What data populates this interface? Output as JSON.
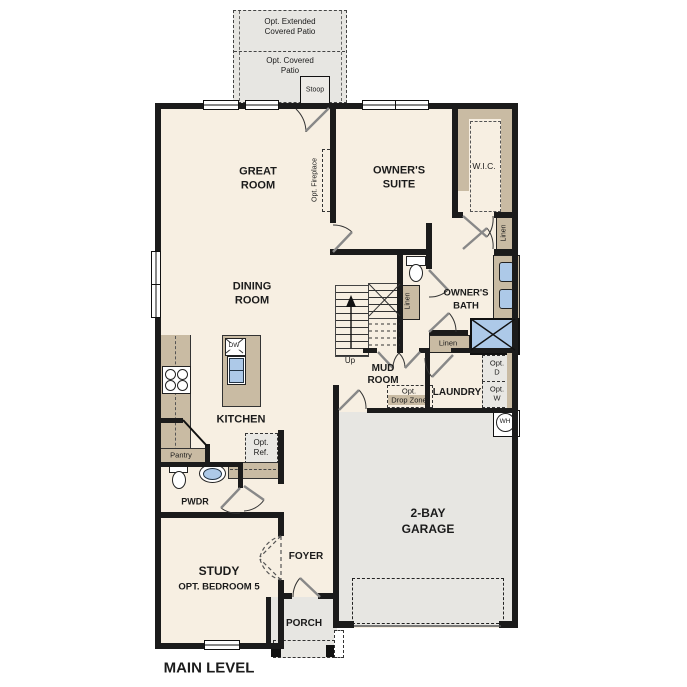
{
  "plan_title": "MAIN LEVEL",
  "outdoor": {
    "patio_extended": {
      "l1": "Opt. Extended",
      "l2": "Covered Patio"
    },
    "patio_covered": {
      "l1": "Opt. Covered",
      "l2": "Patio"
    },
    "stoop": "Stoop",
    "porch": "PORCH"
  },
  "rooms": {
    "great_room": {
      "l1": "GREAT",
      "l2": "ROOM"
    },
    "owners_suite": {
      "l1": "OWNER'S",
      "l2": "SUITE"
    },
    "wic": "W.I.C.",
    "dining": {
      "l1": "DINING",
      "l2": "ROOM"
    },
    "owners_bath": {
      "l1": "OWNER'S",
      "l2": "BATH"
    },
    "kitchen": "KITCHEN",
    "mud_room": {
      "l1": "MUD",
      "l2": "ROOM"
    },
    "laundry": "LAUNDRY",
    "pwdr": "PWDR",
    "study": {
      "l1": "STUDY",
      "l2": "OPT. BEDROOM 5"
    },
    "foyer": "FOYER",
    "garage": {
      "l1": "2-BAY",
      "l2": "GARAGE"
    }
  },
  "features": {
    "opt_fireplace": "Opt. Fireplace",
    "linen_hall": "Linen",
    "linen_stairs": "Linen",
    "linen_bath": "Linen",
    "up": "Up",
    "pantry": "Pantry",
    "opt_ref": {
      "l1": "Opt.",
      "l2": "Ref."
    },
    "dishwasher": "DW",
    "opt_drop_zone": {
      "l1": "Opt.",
      "l2": "Drop Zone"
    },
    "opt_dryer": {
      "l1": "Opt.",
      "l2": "D"
    },
    "opt_washer": {
      "l1": "Opt.",
      "l2": "W"
    },
    "water_heater": "WH"
  },
  "colors": {
    "wall": "#1b1b1b",
    "floor": "#f7efe2",
    "cabinet": "#c9bba3",
    "outdoor": "#e7e6e2",
    "fixture_blue": "#adc9e8"
  }
}
